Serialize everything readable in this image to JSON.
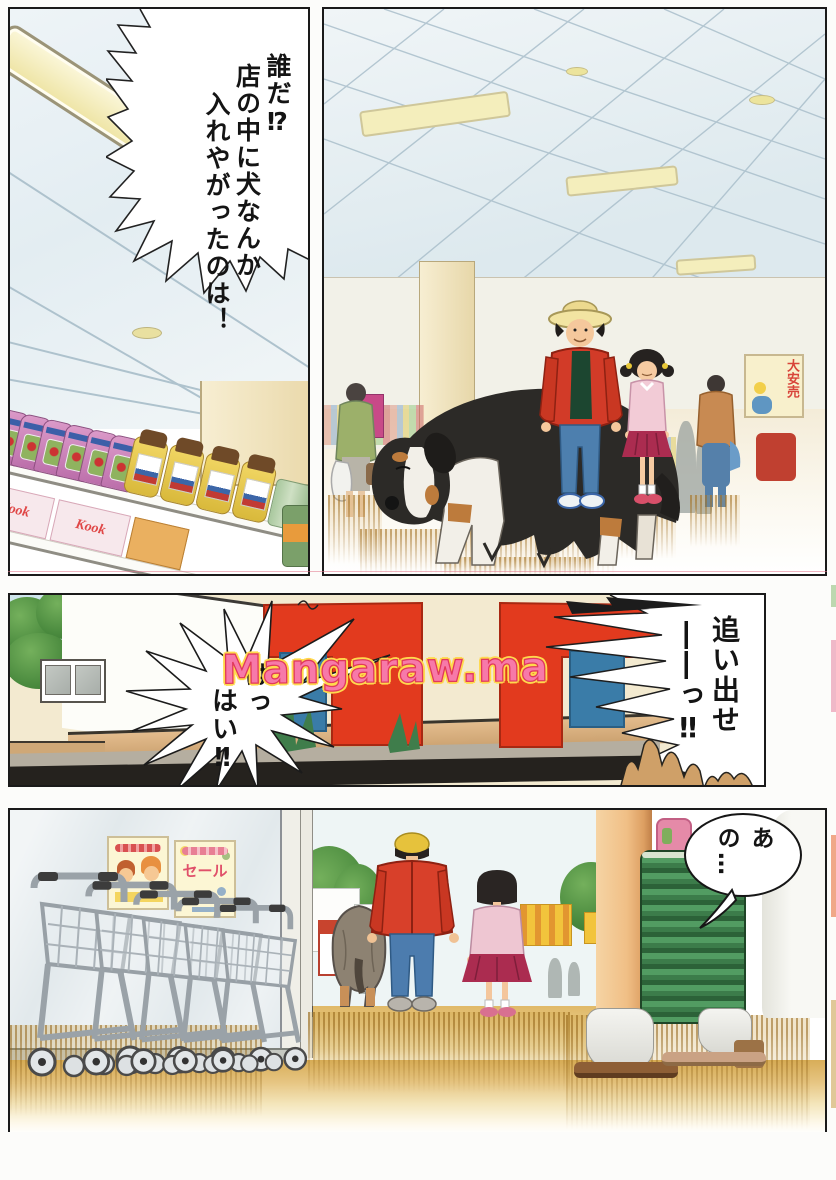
{
  "page": {
    "watermark_text": "Mangaraw.ma"
  },
  "panel1": {
    "shout_lines": [
      "誰だ⁉",
      "店の中に犬なんか",
      "入れやがったのは！"
    ],
    "shelf_box_text": "Kook"
  },
  "panel2": {
    "wall_poster_text": "大安売"
  },
  "panel3": {
    "burst_right_lines": [
      "追い出せ",
      "――っ‼"
    ],
    "burst_left_lines": [
      "はっ",
      "はい‼"
    ]
  },
  "panel4": {
    "speech_text": "あの…",
    "sale_poster_text": "セール"
  },
  "colors": {
    "sign_red": "#e23a1e",
    "sign_blue": "#3a7ca8",
    "jacket_red": "#d8402a",
    "skirt_crimson": "#ab2c50",
    "basket_green": "#3f8750",
    "floor_gold": "#dfb863",
    "watermark_pink": "#f779a9",
    "watermark_outline": "#ffd94d"
  }
}
